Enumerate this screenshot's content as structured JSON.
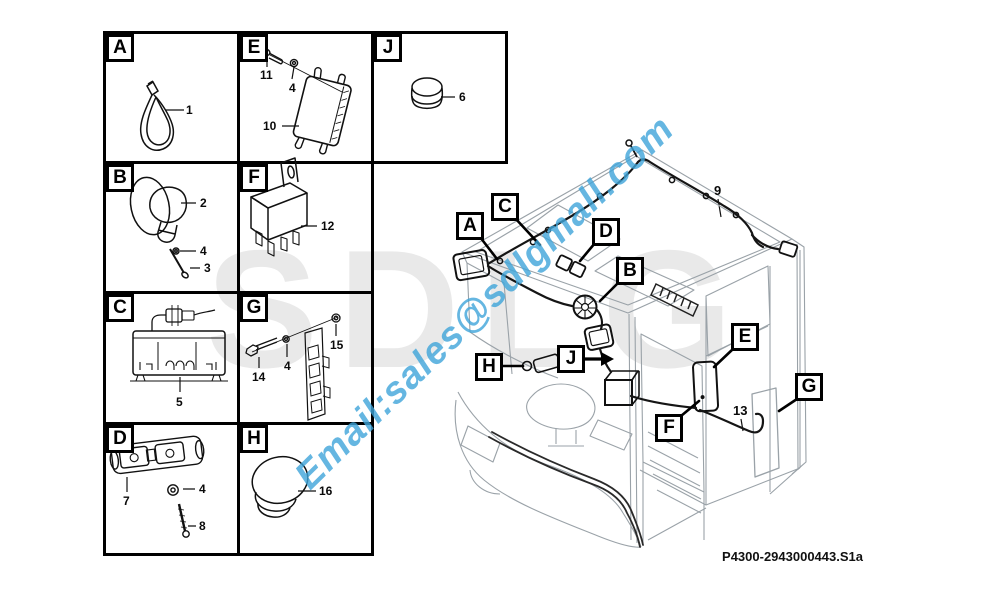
{
  "document": {
    "part_number_label": "P4300-2943000443.S1a"
  },
  "watermark": {
    "logo_text": "SDLG",
    "logo_color": "#e9e9e9",
    "logo_accent_color": "#f8dce0",
    "email_text": "Email:sales@sdlgmall.com",
    "email_color": "#3fa5da"
  },
  "parts_grid": {
    "cells": {
      "A": {
        "letter": "A",
        "labels": {
          "n1": "1"
        }
      },
      "E": {
        "letter": "E",
        "labels": {
          "n11": "11",
          "n4": "4",
          "n10": "10"
        }
      },
      "J": {
        "letter": "J",
        "labels": {
          "n6": "6"
        }
      },
      "B": {
        "letter": "B",
        "labels": {
          "n2": "2",
          "n4": "4",
          "n3": "3"
        }
      },
      "F": {
        "letter": "F",
        "labels": {
          "n12": "12"
        }
      },
      "C": {
        "letter": "C",
        "labels": {
          "n5": "5"
        }
      },
      "G": {
        "letter": "G",
        "labels": {
          "n14": "14",
          "n4": "4",
          "n15": "15"
        }
      },
      "D": {
        "letter": "D",
        "labels": {
          "n7": "7",
          "n4": "4",
          "n8": "8"
        }
      },
      "H": {
        "letter": "H",
        "labels": {
          "n16": "16"
        }
      }
    }
  },
  "diagram": {
    "callouts": {
      "A": "A",
      "B": "B",
      "C": "C",
      "D": "D",
      "E": "E",
      "F": "F",
      "G": "G",
      "H": "H",
      "J": "J"
    },
    "wire_refs": {
      "r9": "9",
      "r13": "13"
    }
  }
}
